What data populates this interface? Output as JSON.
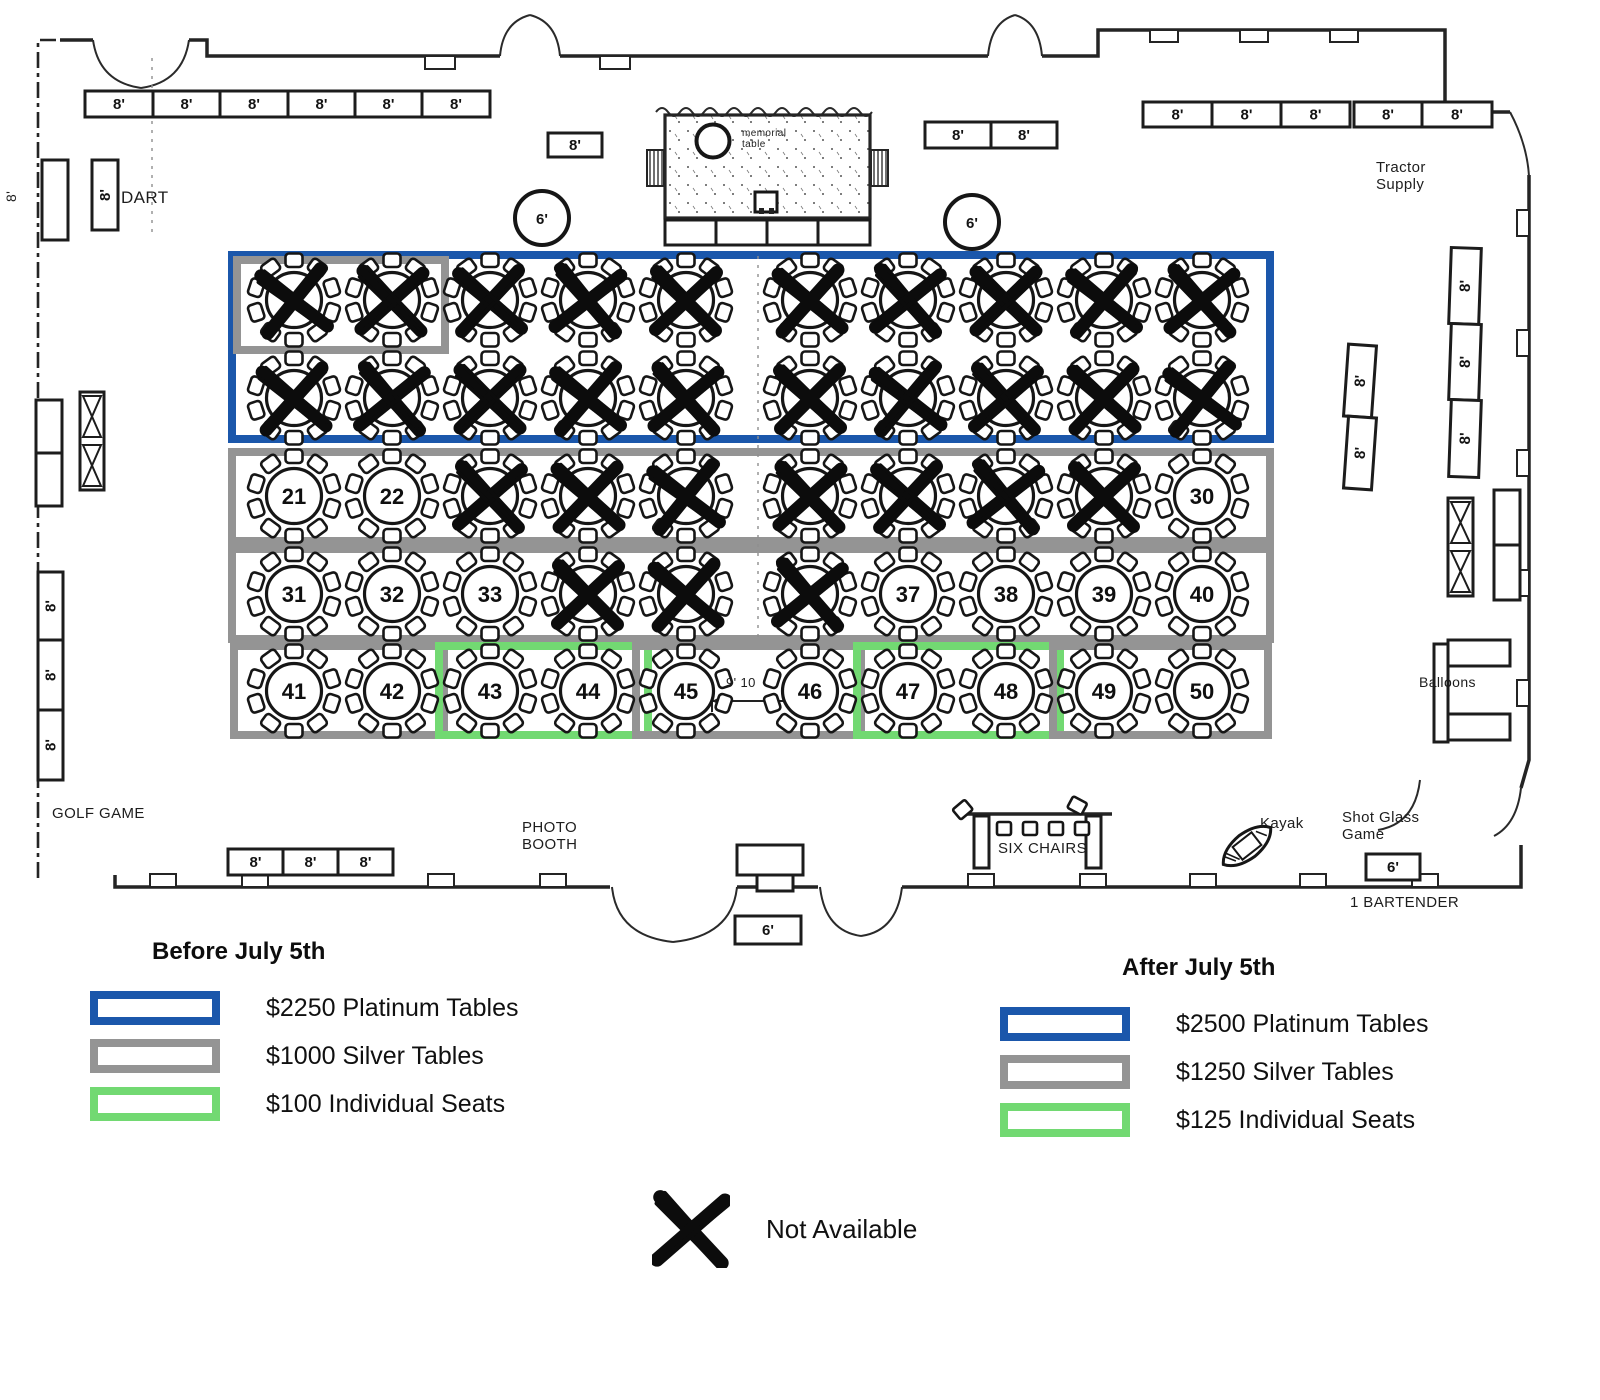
{
  "colors": {
    "platinum_blue": "#1b57ab",
    "silver_gray": "#949494",
    "seat_green": "#72d972",
    "ink": "#161616"
  },
  "legend_before": {
    "title": "Before July 5th",
    "items": [
      {
        "label": "$2250 Platinum Tables",
        "color": "platinum_blue"
      },
      {
        "label": "$1000 Silver Tables",
        "color": "silver_gray"
      },
      {
        "label": "$100 Individual Seats",
        "color": "seat_green"
      }
    ]
  },
  "legend_after": {
    "title": "After July 5th",
    "items": [
      {
        "label": "$2500 Platinum Tables",
        "color": "platinum_blue"
      },
      {
        "label": "$1250 Silver Tables",
        "color": "silver_gray"
      },
      {
        "label": "$125 Individual Seats",
        "color": "seat_green"
      }
    ]
  },
  "not_available": {
    "label": "Not Available"
  },
  "floor": {
    "columns": [
      294,
      392,
      490,
      588,
      686,
      810,
      908,
      1006,
      1104,
      1202
    ],
    "rows": [
      {
        "y": 300,
        "tables": [
          "X",
          "X",
          "X",
          "X",
          "X",
          "X",
          "X",
          "X",
          "X",
          "X"
        ]
      },
      {
        "y": 398,
        "tables": [
          "X",
          "X",
          "X",
          "X",
          "X",
          "X",
          "X",
          "X",
          "X",
          "X"
        ]
      },
      {
        "y": 496,
        "tables": [
          "21",
          "22",
          "X",
          "X",
          "X",
          "X",
          "X",
          "X",
          "X",
          "30"
        ]
      },
      {
        "y": 594,
        "tables": [
          "31",
          "32",
          "33",
          "X",
          "X",
          "X",
          "37",
          "38",
          "39",
          "40"
        ]
      },
      {
        "y": 691,
        "tables": [
          "41",
          "42",
          "43",
          "44",
          "45",
          "46",
          "47",
          "48",
          "49",
          "50"
        ]
      }
    ],
    "zones": [
      {
        "name": "platinum-rows-1-2",
        "color": "platinum_blue",
        "x": 228,
        "y": 251,
        "w": 1046,
        "h": 192,
        "t": 8
      },
      {
        "name": "silver-sub-row1-tables-1-2",
        "color": "silver_gray",
        "x": 233,
        "y": 256,
        "w": 216,
        "h": 98,
        "t": 8
      },
      {
        "name": "silver-row-3",
        "color": "silver_gray",
        "x": 228,
        "y": 448,
        "w": 1046,
        "h": 97,
        "t": 8
      },
      {
        "name": "silver-row-4",
        "color": "silver_gray",
        "x": 228,
        "y": 545,
        "w": 1046,
        "h": 98,
        "t": 8
      },
      {
        "name": "silver-tables-41-42",
        "color": "silver_gray",
        "x": 230,
        "y": 642,
        "w": 218,
        "h": 97,
        "t": 8
      },
      {
        "name": "seats-tables-43-44",
        "color": "seat_green",
        "x": 435,
        "y": 642,
        "w": 217,
        "h": 97,
        "t": 8
      },
      {
        "name": "silver-tables-45-46",
        "color": "silver_gray",
        "x": 632,
        "y": 642,
        "w": 233,
        "h": 97,
        "t": 8
      },
      {
        "name": "seats-tables-47-48",
        "color": "seat_green",
        "x": 853,
        "y": 642,
        "w": 211,
        "h": 97,
        "t": 8
      },
      {
        "name": "silver-tables-49-50",
        "color": "silver_gray",
        "x": 1049,
        "y": 642,
        "w": 223,
        "h": 97,
        "t": 8
      }
    ],
    "rect_tables": [
      {
        "x": 85,
        "y": 91,
        "w": 68,
        "h": 26,
        "label": "8'"
      },
      {
        "x": 153,
        "y": 91,
        "w": 67,
        "h": 26,
        "label": "8'"
      },
      {
        "x": 220,
        "y": 91,
        "w": 68,
        "h": 26,
        "label": "8'"
      },
      {
        "x": 288,
        "y": 91,
        "w": 67,
        "h": 26,
        "label": "8'"
      },
      {
        "x": 355,
        "y": 91,
        "w": 67,
        "h": 26,
        "label": "8'"
      },
      {
        "x": 422,
        "y": 91,
        "w": 68,
        "h": 26,
        "label": "8'"
      },
      {
        "x": 548,
        "y": 133,
        "w": 54,
        "h": 24,
        "label": "8'"
      },
      {
        "x": 925,
        "y": 122,
        "w": 66,
        "h": 26,
        "label": "8'"
      },
      {
        "x": 991,
        "y": 122,
        "w": 66,
        "h": 26,
        "label": "8'"
      },
      {
        "x": 1143,
        "y": 102,
        "w": 69,
        "h": 25,
        "label": "8'"
      },
      {
        "x": 1212,
        "y": 102,
        "w": 69,
        "h": 25,
        "label": "8'"
      },
      {
        "x": 1281,
        "y": 102,
        "w": 69,
        "h": 25,
        "label": "8'"
      },
      {
        "x": 1354,
        "y": 102,
        "w": 68,
        "h": 25,
        "label": "8'"
      },
      {
        "x": 1422,
        "y": 102,
        "w": 70,
        "h": 25,
        "label": "8'"
      },
      {
        "x": 42,
        "y": 160,
        "w": 26,
        "h": 80,
        "label": ""
      },
      {
        "x": 92,
        "y": 160,
        "w": 26,
        "h": 70,
        "label": "8'",
        "vert": true
      },
      {
        "x": 36,
        "y": 400,
        "w": 26,
        "h": 53,
        "label": ""
      },
      {
        "x": 36,
        "y": 453,
        "w": 26,
        "h": 53,
        "label": ""
      },
      {
        "x": 38,
        "y": 572,
        "w": 25,
        "h": 68,
        "label": "8'",
        "vert": true
      },
      {
        "x": 38,
        "y": 640,
        "w": 25,
        "h": 70,
        "label": "8'",
        "vert": true
      },
      {
        "x": 38,
        "y": 710,
        "w": 25,
        "h": 70,
        "label": "8'",
        "vert": true
      },
      {
        "x": 1346,
        "y": 345,
        "w": 28,
        "h": 72,
        "label": "8'",
        "vert": true,
        "rot": 4
      },
      {
        "x": 1346,
        "y": 417,
        "w": 28,
        "h": 72,
        "label": "8'",
        "vert": true,
        "rot": 4
      },
      {
        "x": 1450,
        "y": 248,
        "w": 30,
        "h": 76,
        "label": "8'",
        "vert": true,
        "rot": 2
      },
      {
        "x": 1450,
        "y": 324,
        "w": 30,
        "h": 76,
        "label": "8'",
        "vert": true,
        "rot": 2
      },
      {
        "x": 1450,
        "y": 400,
        "w": 30,
        "h": 77,
        "label": "8'",
        "vert": true,
        "rot": 2
      },
      {
        "x": 1494,
        "y": 490,
        "w": 26,
        "h": 55,
        "label": ""
      },
      {
        "x": 1494,
        "y": 545,
        "w": 26,
        "h": 55,
        "label": ""
      },
      {
        "x": 1434,
        "y": 644,
        "w": 14,
        "h": 98,
        "label": ""
      },
      {
        "x": 1448,
        "y": 640,
        "w": 62,
        "h": 26,
        "label": ""
      },
      {
        "x": 1448,
        "y": 714,
        "w": 62,
        "h": 26,
        "label": ""
      },
      {
        "x": 228,
        "y": 849,
        "w": 55,
        "h": 26,
        "label": "8'"
      },
      {
        "x": 283,
        "y": 849,
        "w": 55,
        "h": 26,
        "label": "8'"
      },
      {
        "x": 338,
        "y": 849,
        "w": 55,
        "h": 26,
        "label": "8'"
      },
      {
        "x": 737,
        "y": 845,
        "w": 66,
        "h": 30,
        "label": ""
      },
      {
        "x": 757,
        "y": 875,
        "w": 36,
        "h": 16,
        "label": ""
      },
      {
        "x": 735,
        "y": 916,
        "w": 66,
        "h": 28,
        "label": "6'"
      },
      {
        "x": 1366,
        "y": 854,
        "w": 54,
        "h": 26,
        "label": "6'"
      },
      {
        "x": 665,
        "y": 220,
        "w": 51,
        "h": 25,
        "label": ""
      },
      {
        "x": 716,
        "y": 220,
        "w": 51,
        "h": 25,
        "label": ""
      },
      {
        "x": 767,
        "y": 220,
        "w": 51,
        "h": 25,
        "label": ""
      },
      {
        "x": 818,
        "y": 220,
        "w": 52,
        "h": 25,
        "label": ""
      }
    ],
    "bowtie_tables": [
      {
        "x": 80,
        "y": 392,
        "w": 24,
        "h": 98
      },
      {
        "x": 1448,
        "y": 498,
        "w": 25,
        "h": 98
      }
    ],
    "round_tables_6ft": [
      {
        "cx": 542,
        "cy": 218,
        "r": 27,
        "label": "6'"
      },
      {
        "cx": 972,
        "cy": 222,
        "r": 27,
        "label": "6'"
      }
    ],
    "labels": [
      {
        "name": "wall-dim-8ft",
        "text": "8'",
        "x": 4,
        "y": 202,
        "size": 14,
        "rot": -90
      },
      {
        "name": "dart",
        "text": "DART",
        "x": 121,
        "y": 188,
        "size": 17
      },
      {
        "name": "tractor-supply",
        "text": "Tractor\nSupply",
        "x": 1376,
        "y": 160,
        "size": 15
      },
      {
        "name": "memorial-table",
        "text": "memorial\ntable",
        "x": 742,
        "y": 128,
        "size": 10
      },
      {
        "name": "golf-game",
        "text": "GOLF GAME",
        "x": 52,
        "y": 806,
        "size": 15
      },
      {
        "name": "photo-booth",
        "text": "PHOTO\nBOOTH",
        "x": 522,
        "y": 820,
        "size": 15
      },
      {
        "name": "six-chairs",
        "text": "SIX CHAIRS",
        "x": 998,
        "y": 841,
        "size": 15
      },
      {
        "name": "kayak",
        "text": "Kayak",
        "x": 1260,
        "y": 816,
        "size": 15
      },
      {
        "name": "shot-glass-game",
        "text": "Shot Glass\nGame",
        "x": 1342,
        "y": 810,
        "size": 15
      },
      {
        "name": "one-bartender",
        "text": "1 BARTENDER",
        "x": 1350,
        "y": 895,
        "size": 15
      },
      {
        "name": "balloons",
        "text": "Balloons",
        "x": 1419,
        "y": 675,
        "size": 14
      },
      {
        "name": "dim-9-10",
        "text": "9' 10",
        "x": 726,
        "y": 676,
        "size": 13
      }
    ]
  }
}
